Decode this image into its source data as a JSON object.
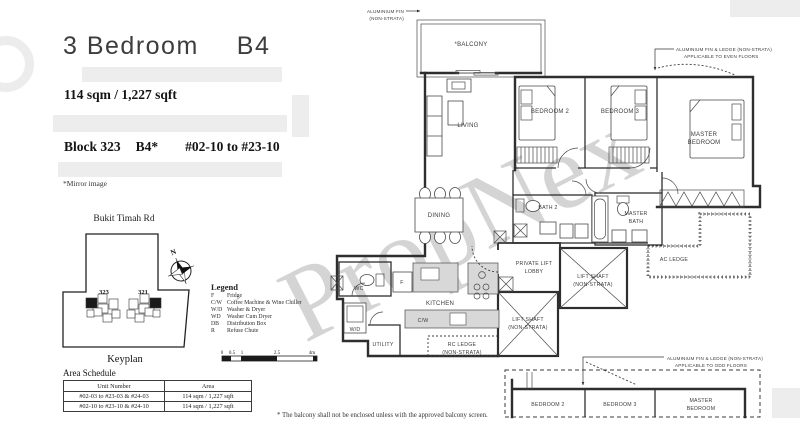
{
  "header": {
    "title": "3 Bedroom",
    "unit_type": "B4",
    "area_text": "114 sqm / 1,227 sqft",
    "block_label": "Block 323",
    "block_type": "B4*",
    "unit_range": "#02-10 to #23-10",
    "mirror_note": "*Mirror image"
  },
  "keyplan": {
    "road": "Bukit Timah Rd",
    "block_left": "323",
    "block_right": "321",
    "caption": "Keyplan",
    "compass": "N"
  },
  "legend": {
    "heading": "Legend",
    "items": [
      {
        "abbr": "F",
        "label": "Fridge"
      },
      {
        "abbr": "C/W",
        "label": "Coffee Machine & Wine Chiller"
      },
      {
        "abbr": "W/D",
        "label": "Washer & Dryer"
      },
      {
        "abbr": "WD",
        "label": "Washer Cum Dryer"
      },
      {
        "abbr": "DB",
        "label": "Distribution Box"
      },
      {
        "abbr": "R",
        "label": "Refuse Chute"
      }
    ],
    "scale_ticks": [
      "0",
      "0.5",
      "1",
      "2.5",
      "4m"
    ]
  },
  "area_schedule": {
    "heading": "Area Schedule",
    "columns": [
      "Unit Number",
      "Area"
    ],
    "rows": [
      {
        "unit": "#02-03 to #23-03 & #24-03",
        "area": "114 sqm / 1,227 sqft"
      },
      {
        "unit": "#02-10 to #23-10 & #24-10",
        "area": "114 sqm / 1,227 sqft"
      }
    ]
  },
  "floorplan": {
    "rooms": {
      "balcony": "*BALCONY",
      "living": "LIVING",
      "dining": "DINING",
      "kitchen": "KITCHEN",
      "wc": "WC",
      "utility": "UTILITY",
      "bedroom2": "BEDROOM 2",
      "bedroom3": "BEDROOM 3",
      "master_line1": "MASTER",
      "master_line2": "BEDROOM",
      "bath2": "BATH 2",
      "master_bath_line1": "MASTER",
      "master_bath_line2": "BATH",
      "lobby_line1": "PRIVATE LIFT",
      "lobby_line2": "LOBBY",
      "lift_line1": "LIFT SHAFT",
      "lift_line2": "(NON-STRATA)",
      "ac_ledge": "AC LEDGE",
      "rc_ledge_line1": "RC LEDGE",
      "rc_ledge_line2": "(NON-STRATA)"
    },
    "appliances": {
      "fridge": "F",
      "coffee_wine": "C/W",
      "washer_dryer": "W/D"
    },
    "annotations": {
      "fin_top_line1": "ALUMINIUM FIN",
      "fin_top_line2": "(NON-STRATA)",
      "fin_even_line1": "ALUMINIUM FIN & LEDGE (NON-STRATA)",
      "fin_even_line2": "APPLICABLE TO EVEN FLOORS",
      "fin_odd_line1": "ALUMINIUM FIN & LEDGE (NON-STRATA)",
      "fin_odd_line2": "APPLICABLE TO ODD FLOORS"
    },
    "footnote": "* The balcony shall not be enclosed unless with the approved balcony screen."
  },
  "watermark": "PropNex",
  "colors": {
    "line": "#2e2e2e",
    "counter_fill": "#d8d8d8",
    "watermark": "#9a9a9a"
  }
}
